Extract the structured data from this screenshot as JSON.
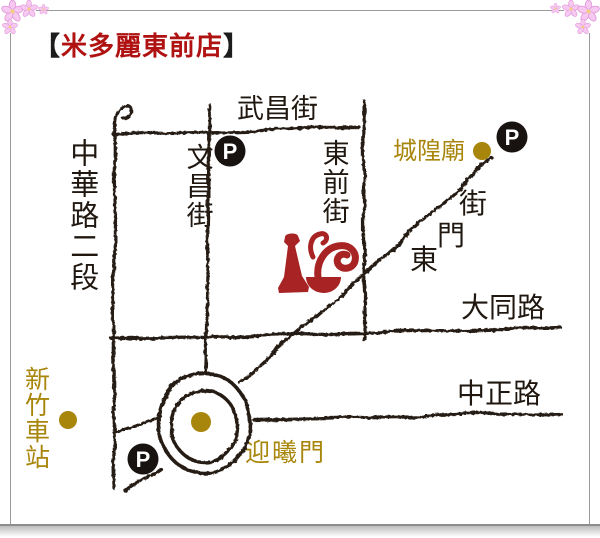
{
  "title": {
    "bracket_open": "【",
    "name": "米多麗東前店",
    "bracket_close": "】"
  },
  "colors": {
    "title_red": "#B01212",
    "logo_red": "#A82323",
    "gold": "#A8860B",
    "road_ink": "#251C12",
    "frame_gray": "#9A9A9A",
    "flower_pink": "#F5C3EF"
  },
  "map": {
    "streets": {
      "wuchang": "武昌街",
      "wenchang": "文昌街",
      "zhonghua_sec2": "中華路二段",
      "dongqian": "東前街",
      "datong": "大同路",
      "zhongzheng": "中正路",
      "dongmen_chars": [
        "街",
        "門",
        "東"
      ]
    },
    "landmarks": {
      "chenghuang_temple": "城隍廟",
      "hsinchu_station": "新竹車站",
      "yingxi_gate": "迎曦門"
    },
    "parking_label": "P"
  }
}
